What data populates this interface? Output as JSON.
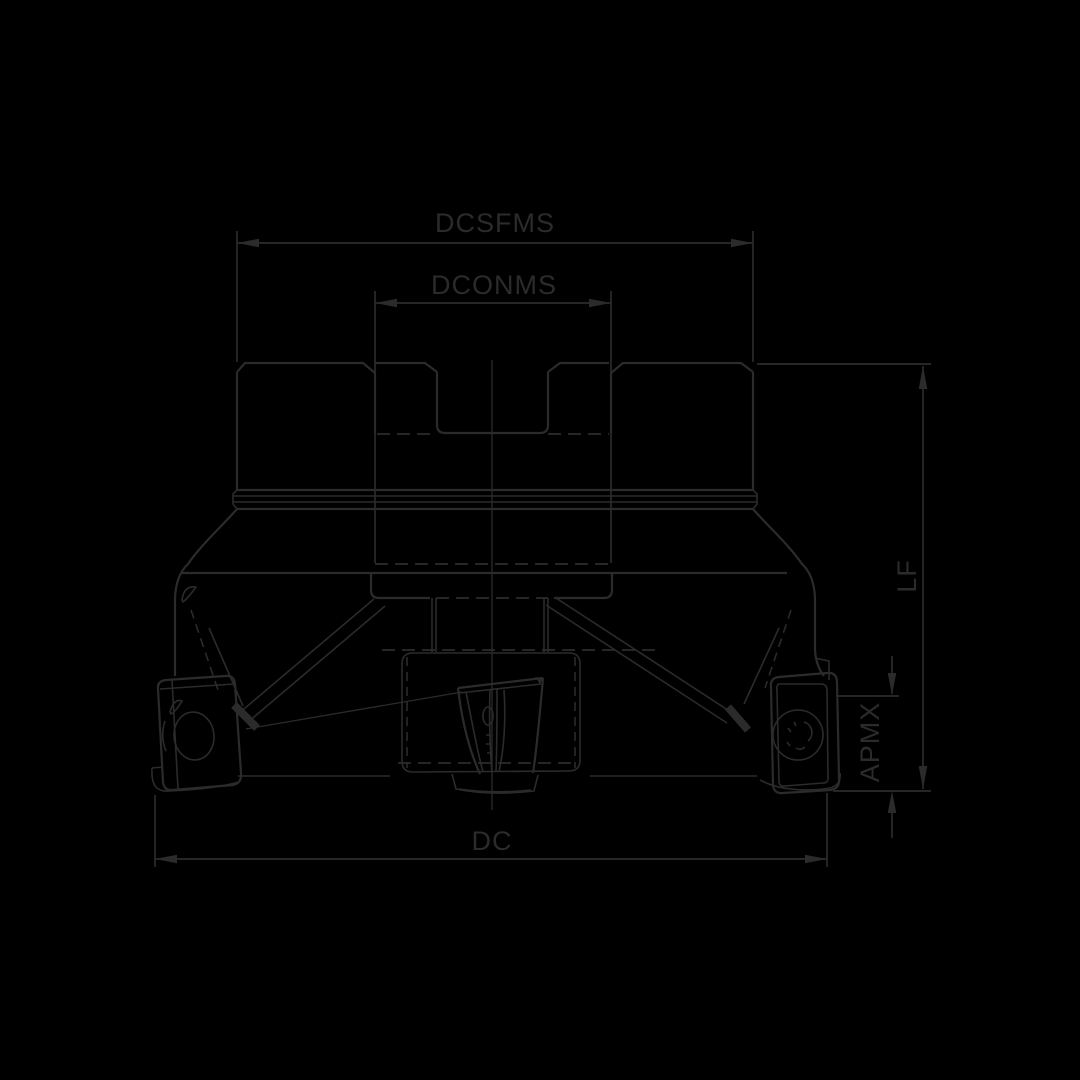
{
  "drawing": {
    "type": "technical-dimension-drawing",
    "subject": "face-milling-cutter-front-view",
    "background_color": "#000000",
    "line_color": "#2b2b2b",
    "labels": {
      "dcsfms": "DCSFMS",
      "dconms": "DCONMS",
      "lf": "LF",
      "apmx": "APMX",
      "dc": "DC"
    }
  }
}
